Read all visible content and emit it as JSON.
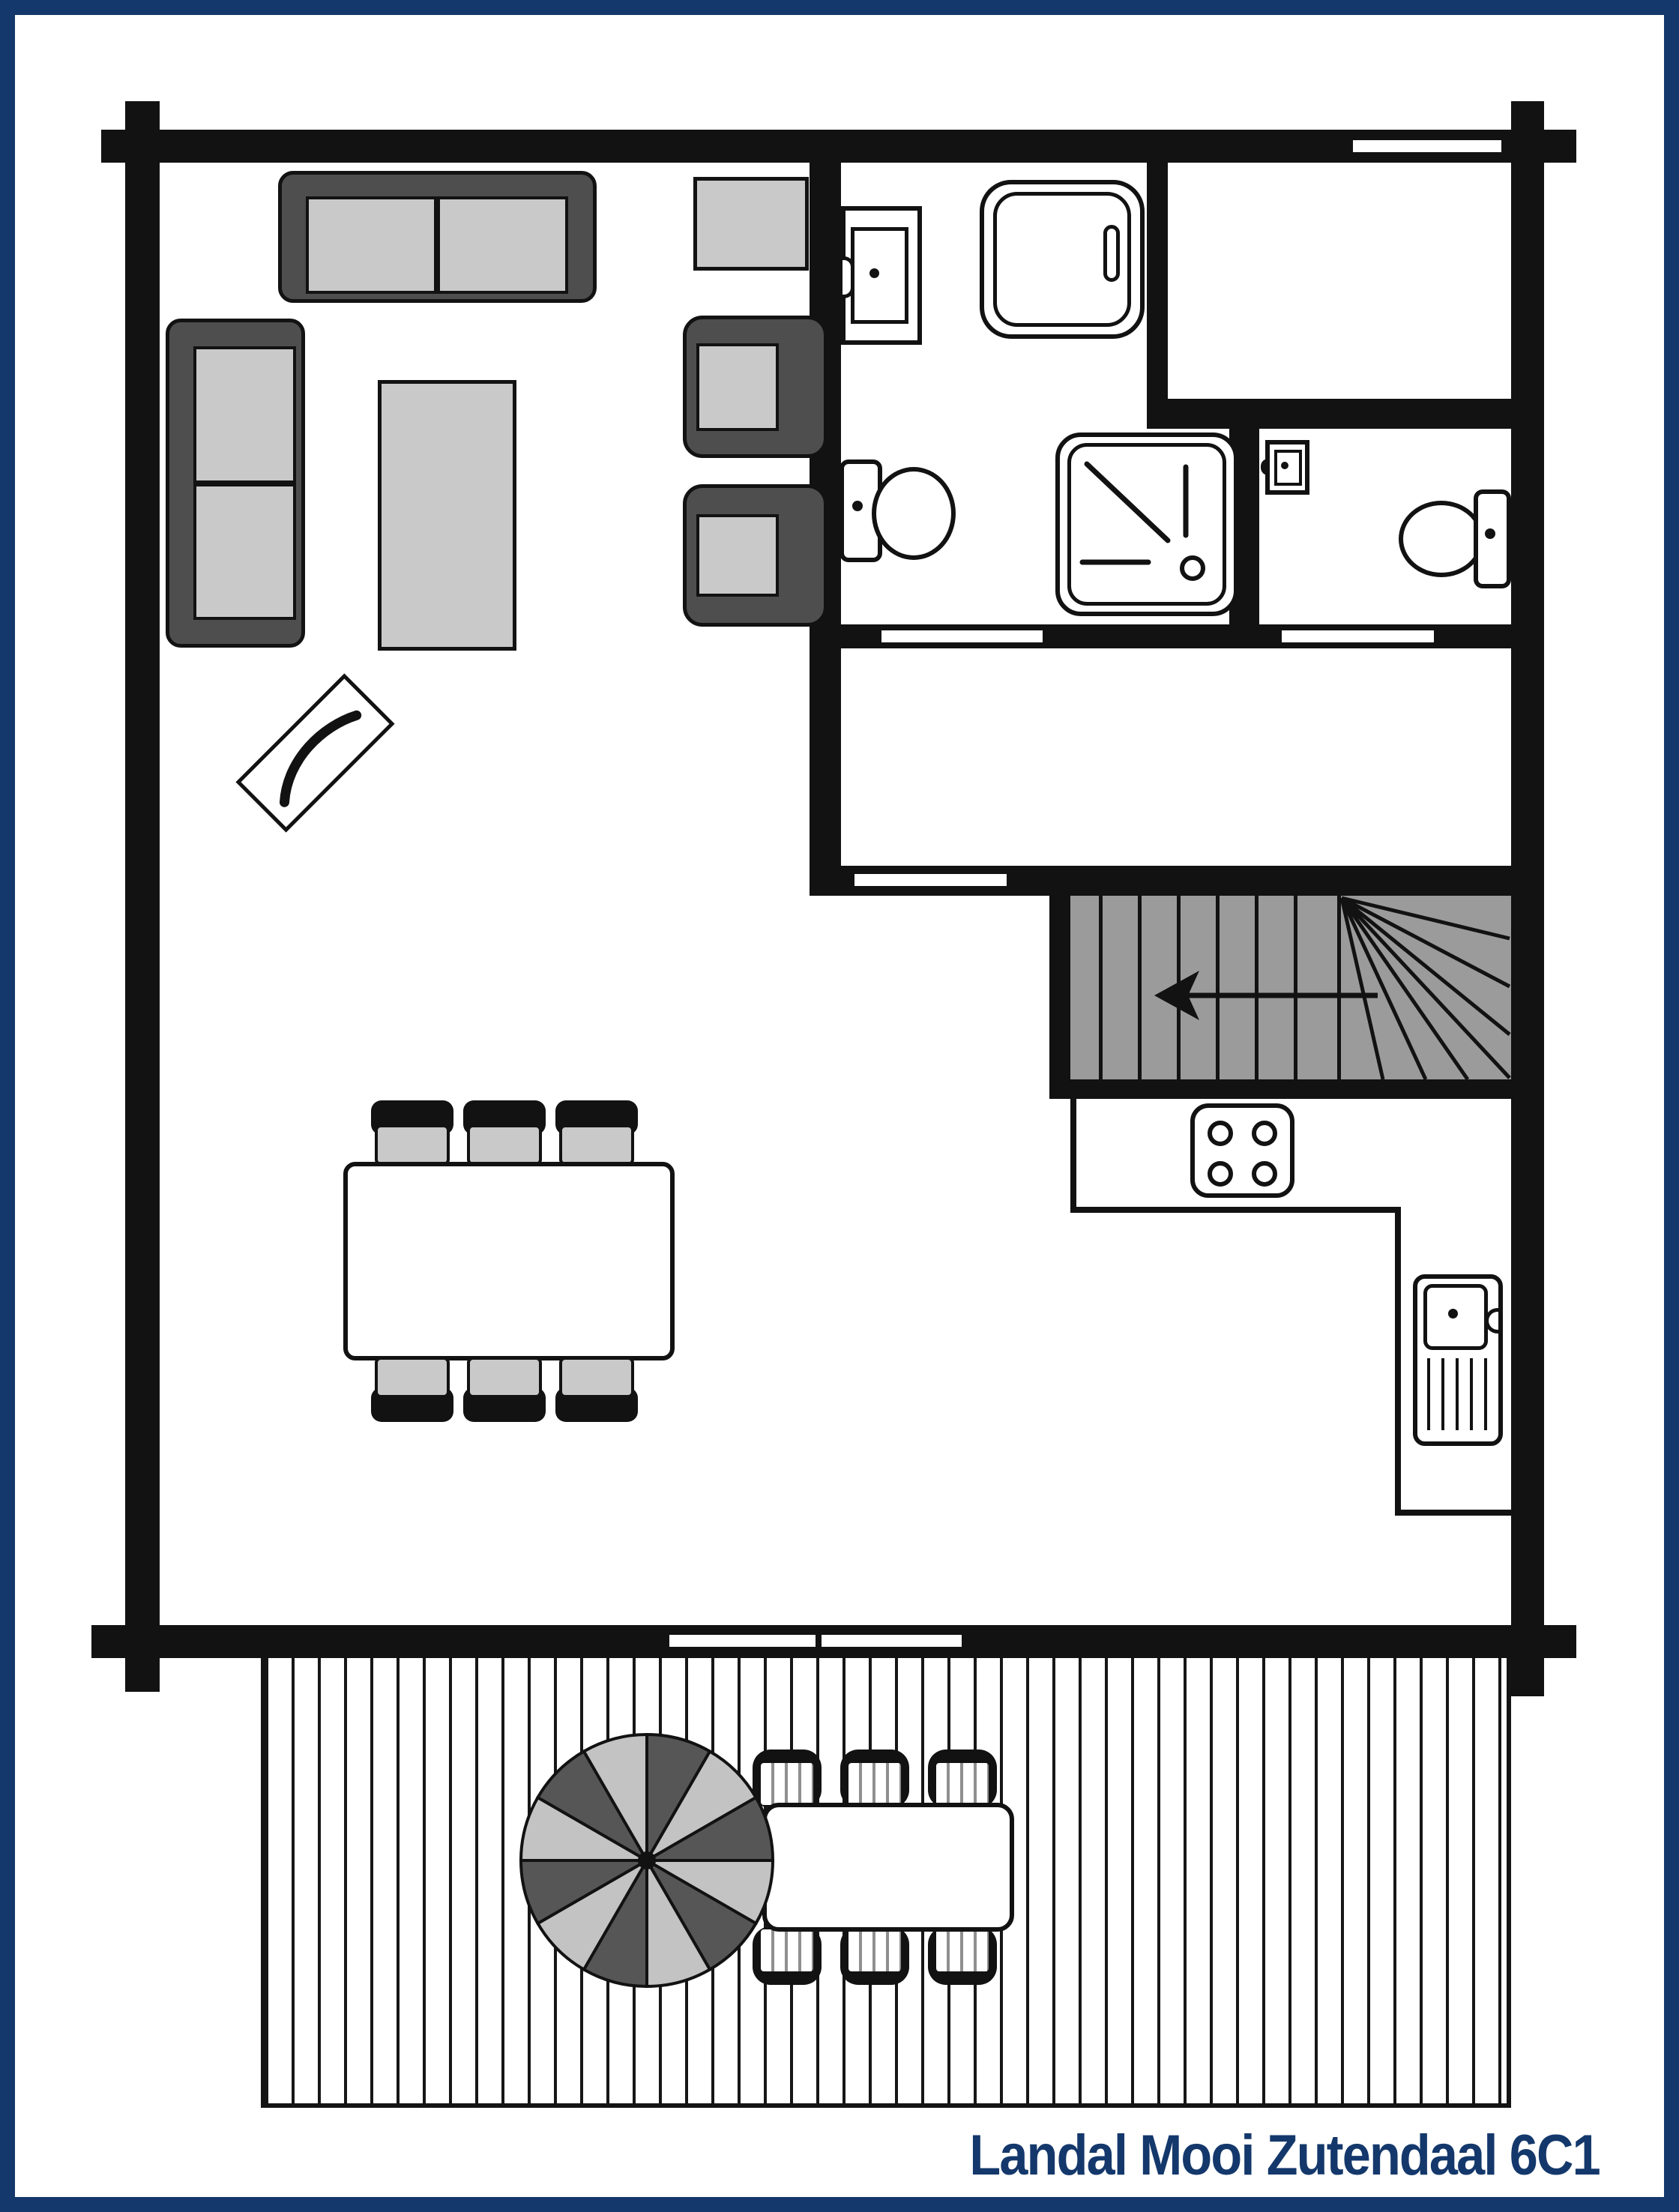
{
  "title": {
    "text": "Landal Mooi Zutendaal 6C1"
  },
  "colors": {
    "accent": "#14386b",
    "wall": "#121212",
    "stair": "#9b9b9b",
    "fdark": "#4e4e4e",
    "flight": "#c9c9c9",
    "pdark": "#565656",
    "plight": "#c3c3c3",
    "bg": "#ffffff"
  }
}
